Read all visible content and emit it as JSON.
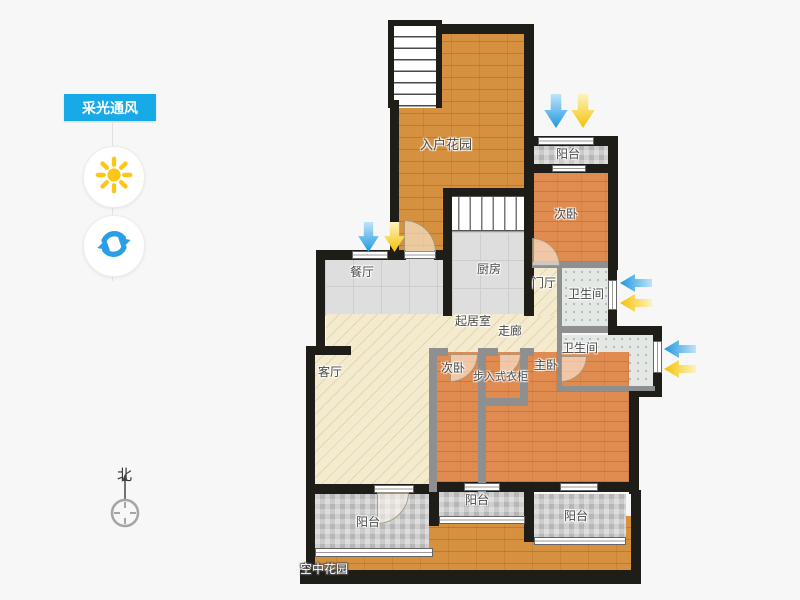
{
  "ui": {
    "badge": {
      "label": "采光通风",
      "color": "#18a9e9"
    },
    "buttons": [
      {
        "id": "sun",
        "icon": "sun-icon",
        "color": "#fdc616"
      },
      {
        "id": "rotate",
        "icon": "rotate-icon",
        "color": "#2b9fe5"
      }
    ],
    "compass": {
      "label": "北"
    }
  },
  "floorplan": {
    "labels": {
      "entrance_garden": "入户花园",
      "balcony_top": "阳台",
      "bedroom_top": "次卧",
      "kitchen": "厨房",
      "dining_room": "餐厅",
      "foyer": "门厅",
      "bathroom_1": "卫生间",
      "bathroom_2": "卫生间",
      "living_room": "起居室",
      "corridor": "走廊",
      "lounge": "客厅",
      "bedroom_2": "次卧",
      "walk_in_closet": "步入式衣柜",
      "master_bedroom": "主卧",
      "balcony_left": "阳台",
      "balcony_middle": "阳台",
      "balcony_right": "阳台",
      "sky_garden": "空中花园"
    },
    "arrow_colors": {
      "wind": "#29a3e8",
      "light": "#f8c911"
    }
  }
}
